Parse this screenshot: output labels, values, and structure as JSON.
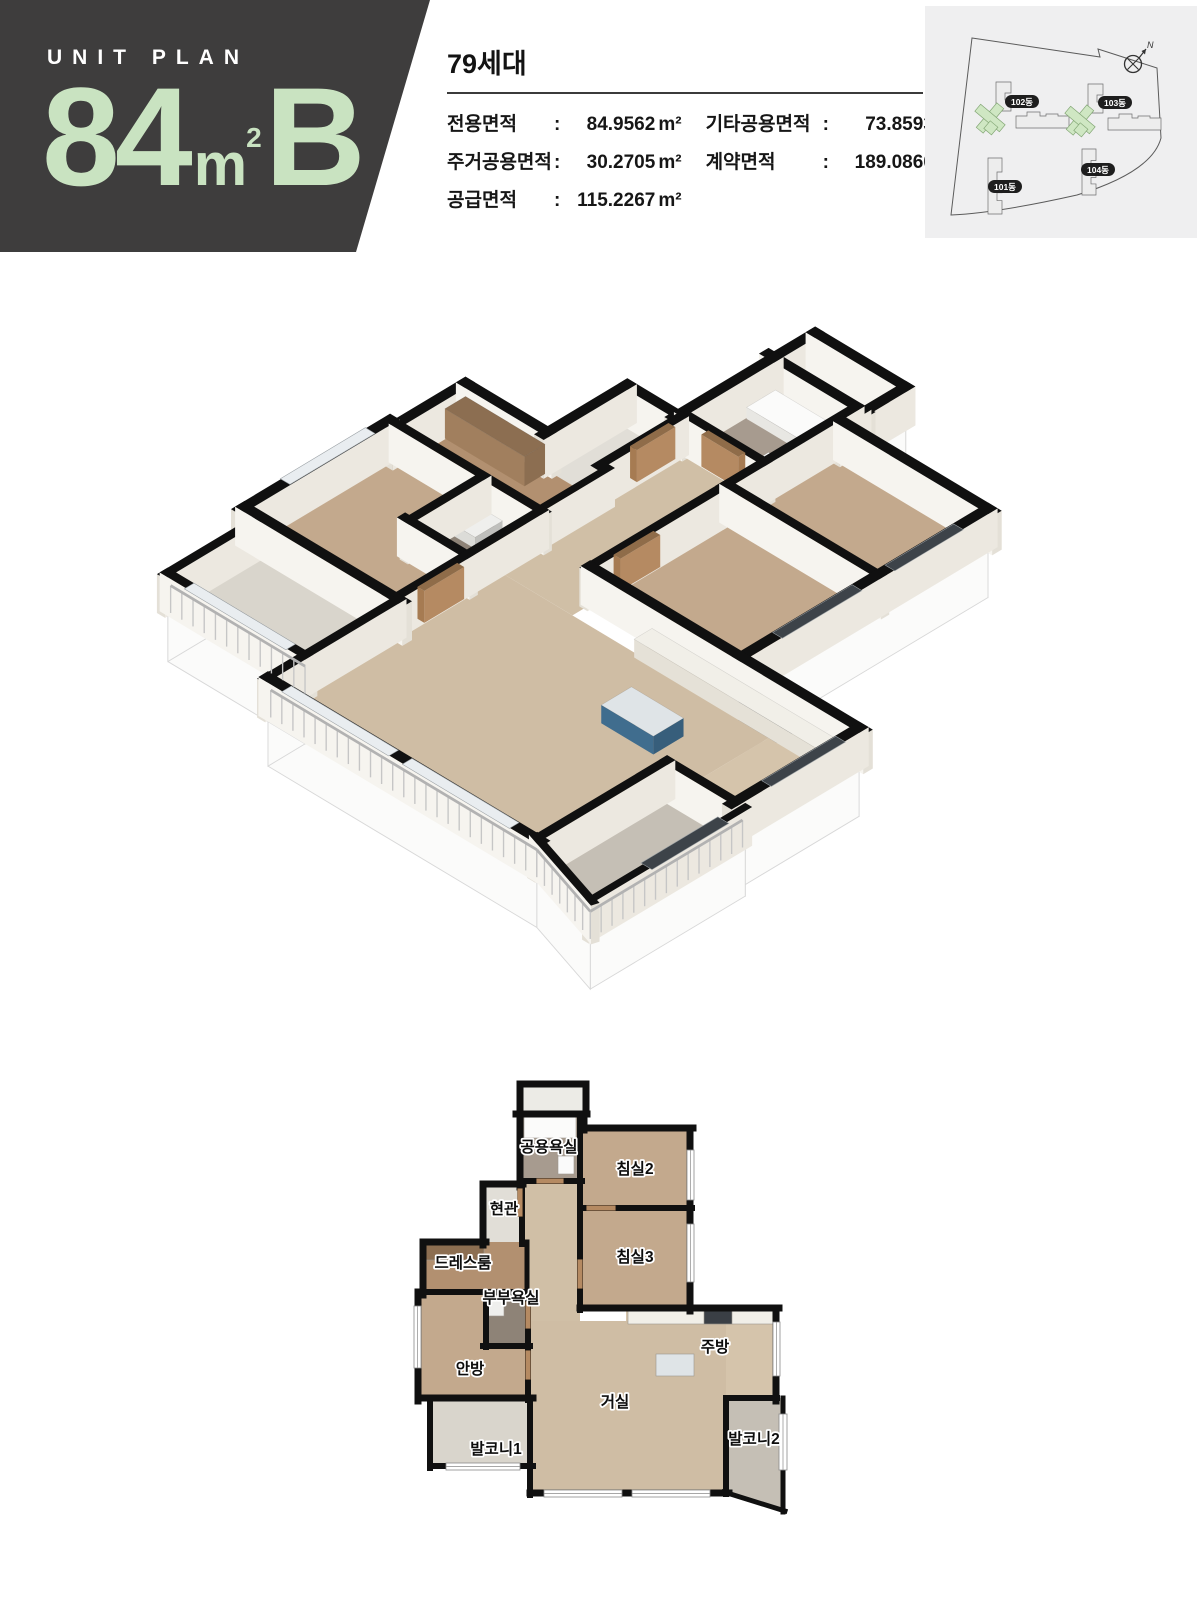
{
  "header": {
    "eyebrow": "UNIT PLAN",
    "big_number": "84",
    "big_unit": "m",
    "big_unit_sup": "2",
    "type_letter": "B",
    "panel_bg": "#3e3d3d",
    "accent_green": "#c9e3c1"
  },
  "summary": {
    "households": "79세대",
    "specs_col1": [
      {
        "label": "전용면적",
        "value": "84.9562",
        "unit": "m²"
      },
      {
        "label": "주거공용면적",
        "value": "30.2705",
        "unit": "m²"
      },
      {
        "label": "공급면적",
        "value": "115.2267",
        "unit": "m²"
      }
    ],
    "specs_col2": [
      {
        "label": "기타공용면적",
        "value": "73.8593",
        "unit": "m²"
      },
      {
        "label": "계약면적",
        "value": "189.0860",
        "unit": "m²"
      }
    ]
  },
  "site_plan": {
    "compass_label": "N",
    "bg": "#efeff0",
    "building_fill": "#ededed",
    "building_stroke": "#6f6f6f",
    "highlight_fill": "#cfe7c3",
    "highlight_stroke": "#85a877",
    "badge_bg": "#1e1e1e",
    "badge_text": "#ffffff",
    "boundary_path": "M47,32 L175,51 L173,43 L232,62 L236,132 Q227,166 152,189 Q72,207 26,209 Z",
    "buildings": [
      {
        "name": "102동",
        "badge": [
          97,
          96
        ],
        "green": [
          65,
          112
        ],
        "tower": [
          71,
          76
        ],
        "slab": [
          91,
          110
        ]
      },
      {
        "name": "103동",
        "badge": [
          190,
          97
        ],
        "green": [
          155,
          114
        ],
        "tower": [
          163,
          78
        ],
        "slab": [
          183,
          112
        ]
      },
      {
        "name": "101동",
        "badge": [
          80,
          181
        ],
        "vert": [
          63,
          152,
          56
        ]
      },
      {
        "name": "104동",
        "badge": [
          173,
          164
        ],
        "vert": [
          157,
          143,
          46
        ]
      }
    ]
  },
  "floor_plan": {
    "colors": {
      "wall": "#101010",
      "wood_dark": "#c3a98d",
      "wood_light": "#cfbda4"
    },
    "outlines": [
      [
        [
          112,
          58
        ],
        [
          178,
          58
        ],
        [
          178,
          72
        ],
        [
          282,
          72
        ],
        [
          282,
          252
        ],
        [
          368,
          252
        ],
        [
          368,
          342
        ],
        [
          375,
          342
        ],
        [
          375,
          455
        ],
        [
          318,
          437
        ],
        [
          122,
          437
        ],
        [
          122,
          410
        ],
        [
          22,
          410
        ],
        [
          22,
          342
        ],
        [
          10,
          342
        ],
        [
          10,
          236
        ],
        [
          15,
          236
        ],
        [
          15,
          186
        ],
        [
          75,
          186
        ],
        [
          75,
          128
        ],
        [
          112,
          128
        ]
      ],
      [
        [
          112,
          28
        ],
        [
          178,
          28
        ],
        [
          178,
          58
        ],
        [
          112,
          58
        ]
      ]
    ],
    "rooms": [
      {
        "n": "utility-balcony",
        "f": "#ecebe6",
        "p": [
          [
            112,
            30
          ],
          [
            178,
            30
          ],
          [
            178,
            58
          ],
          [
            112,
            58
          ]
        ]
      },
      {
        "n": "bath-common",
        "f": "#a79b8f",
        "p": [
          [
            112,
            58
          ],
          [
            172,
            58
          ],
          [
            172,
            125
          ],
          [
            112,
            125
          ]
        ]
      },
      {
        "n": "bedroom2",
        "f": "#c3a98d",
        "p": [
          [
            172,
            72
          ],
          [
            282,
            72
          ],
          [
            282,
            152
          ],
          [
            172,
            152
          ]
        ]
      },
      {
        "n": "bedroom3",
        "f": "#c3a98d",
        "p": [
          [
            172,
            152
          ],
          [
            282,
            152
          ],
          [
            282,
            252
          ],
          [
            172,
            252
          ]
        ]
      },
      {
        "n": "hall",
        "f": "#d0bfa6",
        "p": [
          [
            114,
            125
          ],
          [
            172,
            125
          ],
          [
            172,
            265
          ],
          [
            120,
            265
          ],
          [
            120,
            186
          ],
          [
            114,
            186
          ]
        ]
      },
      {
        "n": "entrance",
        "f": "#e1ded7",
        "p": [
          [
            75,
            128
          ],
          [
            114,
            128
          ],
          [
            114,
            186
          ],
          [
            75,
            186
          ]
        ]
      },
      {
        "n": "dressroom",
        "f": "#b29070",
        "p": [
          [
            15,
            186
          ],
          [
            118,
            186
          ],
          [
            118,
            236
          ],
          [
            15,
            236
          ]
        ]
      },
      {
        "n": "master-bath",
        "f": "#8e8377",
        "p": [
          [
            78,
            236
          ],
          [
            118,
            236
          ],
          [
            118,
            290
          ],
          [
            78,
            290
          ]
        ]
      },
      {
        "n": "master-bedroom",
        "f": "#c3a98d",
        "p": [
          [
            10,
            236
          ],
          [
            78,
            236
          ],
          [
            78,
            290
          ],
          [
            118,
            290
          ],
          [
            118,
            342
          ],
          [
            10,
            342
          ]
        ]
      },
      {
        "n": "kitchen",
        "f": "#d5c4ab",
        "p": [
          [
            218,
            252
          ],
          [
            368,
            252
          ],
          [
            368,
            342
          ],
          [
            318,
            342
          ],
          [
            318,
            265
          ],
          [
            218,
            265
          ]
        ]
      },
      {
        "n": "living",
        "f": "#cfbda4",
        "p": [
          [
            122,
            265
          ],
          [
            318,
            265
          ],
          [
            318,
            437
          ],
          [
            122,
            437
          ]
        ]
      },
      {
        "n": "balcony1",
        "f": "#d9d5cc",
        "p": [
          [
            22,
            342
          ],
          [
            122,
            342
          ],
          [
            122,
            410
          ],
          [
            22,
            410
          ]
        ]
      },
      {
        "n": "balcony2",
        "f": "#c5bfb5",
        "p": [
          [
            318,
            342
          ],
          [
            375,
            342
          ],
          [
            375,
            455
          ],
          [
            318,
            437
          ]
        ]
      }
    ],
    "walls": [
      {
        "a": [
          112,
          28
        ],
        "b": [
          178,
          28
        ],
        "t": 7
      },
      {
        "a": [
          112,
          28
        ],
        "b": [
          112,
          58
        ],
        "t": 7
      },
      {
        "a": [
          178,
          28
        ],
        "b": [
          178,
          58
        ],
        "t": 7
      },
      {
        "a": [
          108,
          58
        ],
        "b": [
          179,
          58
        ],
        "t": 7
      },
      {
        "a": [
          176,
          58
        ],
        "b": [
          176,
          74
        ],
        "t": 7
      },
      {
        "a": [
          176,
          72
        ],
        "b": [
          285,
          72
        ],
        "t": 7
      },
      {
        "a": [
          282,
          72
        ],
        "b": [
          282,
          255
        ],
        "t": 7
      },
      {
        "a": [
          172,
          252
        ],
        "b": [
          371,
          252
        ],
        "t": 7
      },
      {
        "a": [
          368,
          252
        ],
        "b": [
          368,
          345
        ],
        "t": 7
      },
      {
        "a": [
          10,
          236
        ],
        "b": [
          10,
          345
        ],
        "t": 7
      },
      {
        "a": [
          15,
          186
        ],
        "b": [
          15,
          239
        ],
        "t": 7
      },
      {
        "a": [
          15,
          186
        ],
        "b": [
          78,
          186
        ],
        "t": 7
      },
      {
        "a": [
          75,
          128
        ],
        "b": [
          75,
          189
        ],
        "t": 7
      },
      {
        "a": [
          75,
          128
        ],
        "b": [
          115,
          128
        ],
        "t": 7
      },
      {
        "a": [
          112,
          58
        ],
        "b": [
          112,
          131
        ],
        "t": 7
      },
      {
        "a": [
          10,
          342
        ],
        "b": [
          125,
          342
        ],
        "t": 7
      },
      {
        "a": [
          22,
          342
        ],
        "b": [
          22,
          412
        ],
        "t": 6
      },
      {
        "a": [
          22,
          410
        ],
        "b": [
          125,
          410
        ],
        "t": 6
      },
      {
        "a": [
          122,
          342
        ],
        "b": [
          122,
          439
        ],
        "t": 6
      },
      {
        "a": [
          122,
          437
        ],
        "b": [
          321,
          437
        ],
        "t": 7
      },
      {
        "a": [
          318,
          342
        ],
        "b": [
          369,
          342
        ],
        "t": 6
      },
      {
        "a": [
          318,
          342
        ],
        "b": [
          318,
          438
        ],
        "t": 6
      },
      {
        "a": [
          375,
          342
        ],
        "b": [
          375,
          456
        ],
        "t": 5
      },
      {
        "a": [
          316,
          436
        ],
        "b": [
          377,
          455
        ],
        "t": 5
      },
      {
        "a": [
          172,
          58
        ],
        "b": [
          172,
          155
        ],
        "t": 6
      },
      {
        "a": [
          112,
          125
        ],
        "b": [
          174,
          125
        ],
        "t": 6
      },
      {
        "a": [
          172,
          152
        ],
        "b": [
          284,
          152
        ],
        "t": 6
      },
      {
        "a": [
          172,
          152
        ],
        "b": [
          172,
          254
        ],
        "t": 6
      },
      {
        "a": [
          114,
          128
        ],
        "b": [
          114,
          188
        ],
        "t": 6
      },
      {
        "a": [
          119,
          186
        ],
        "b": [
          119,
          238
        ],
        "t": 5
      },
      {
        "a": [
          15,
          236
        ],
        "b": [
          122,
          236
        ],
        "t": 6
      },
      {
        "a": [
          78,
          236
        ],
        "b": [
          78,
          291
        ],
        "t": 6
      },
      {
        "a": [
          75,
          290
        ],
        "b": [
          122,
          290
        ],
        "t": 6
      },
      {
        "a": [
          120,
          236
        ],
        "b": [
          120,
          344
        ],
        "t": 6
      }
    ],
    "doors": [
      {
        "a": [
          112,
          135
        ],
        "b": [
          112,
          158
        ],
        "t": 5
      },
      {
        "a": [
          181,
          152
        ],
        "b": [
          205,
          152
        ],
        "t": 5
      },
      {
        "a": [
          172,
          206
        ],
        "b": [
          172,
          230
        ],
        "t": 5
      },
      {
        "a": [
          120,
          297
        ],
        "b": [
          120,
          321
        ],
        "t": 5
      },
      {
        "a": [
          131,
          125
        ],
        "b": [
          153,
          125
        ],
        "t": 5
      },
      {
        "a": [
          120,
          248
        ],
        "b": [
          120,
          270
        ],
        "t": 5
      }
    ],
    "windows": [
      [
        279,
        94,
        7,
        50
      ],
      [
        279,
        168,
        7,
        58
      ],
      [
        365,
        266,
        7,
        54
      ],
      [
        6,
        250,
        7,
        62
      ],
      [
        38,
        407,
        74,
        7
      ],
      [
        136,
        434,
        78,
        7
      ],
      [
        224,
        434,
        78,
        7
      ],
      [
        371,
        358,
        8,
        56
      ]
    ],
    "furniture": [
      {
        "r": [
          116,
          61,
          52,
          21
        ],
        "h": 10,
        "top": "#fbfbfa",
        "face": "#e8e7e3"
      },
      {
        "r": [
          150,
          100,
          16,
          18
        ],
        "h": 8,
        "top": "#fafafa",
        "face": "#e5e5e2"
      },
      {
        "r": [
          220,
          255,
          146,
          13
        ],
        "h": 16,
        "top": "#f1efe8",
        "face": "#e5e1d7"
      },
      {
        "r": [
          296,
          255,
          28,
          13
        ],
        "h": 17,
        "top": "#3a3f45",
        "face": "#4a4f55"
      },
      {
        "r": [
          248,
          298,
          38,
          22
        ],
        "h": 16,
        "top": "#dfe4e7",
        "face": "#406d8e"
      },
      {
        "r": [
          18,
          189,
          58,
          15
        ],
        "h": 26,
        "top": "#8c6e51",
        "face": "#a17f5e"
      },
      {
        "r": [
          80,
          240,
          16,
          20
        ],
        "h": 10,
        "top": "#efefed",
        "face": "#dcdcd8"
      }
    ],
    "railings": [
      {
        "a": [
          24,
          410
        ],
        "b": [
          122,
          410
        ]
      },
      {
        "a": [
          124,
          437
        ],
        "b": [
          318,
          437
        ]
      },
      {
        "a": [
          318,
          437
        ],
        "b": [
          375,
          455
        ]
      },
      {
        "a": [
          375,
          344
        ],
        "b": [
          375,
          455
        ]
      }
    ],
    "labels": [
      {
        "t": "공용욕실",
        "x": 141,
        "y": 96
      },
      {
        "t": "침실2",
        "x": 227,
        "y": 118
      },
      {
        "t": "현관",
        "x": 96,
        "y": 158
      },
      {
        "t": "드레스룸",
        "x": 55,
        "y": 212
      },
      {
        "t": "부부욕실",
        "x": 103,
        "y": 247
      },
      {
        "t": "침실3",
        "x": 227,
        "y": 206
      },
      {
        "t": "안방",
        "x": 62,
        "y": 318
      },
      {
        "t": "주방",
        "x": 307,
        "y": 296
      },
      {
        "t": "거실",
        "x": 207,
        "y": 351
      },
      {
        "t": "발코니1",
        "x": 88,
        "y": 398
      },
      {
        "t": "발코니2",
        "x": 346,
        "y": 388
      }
    ]
  }
}
